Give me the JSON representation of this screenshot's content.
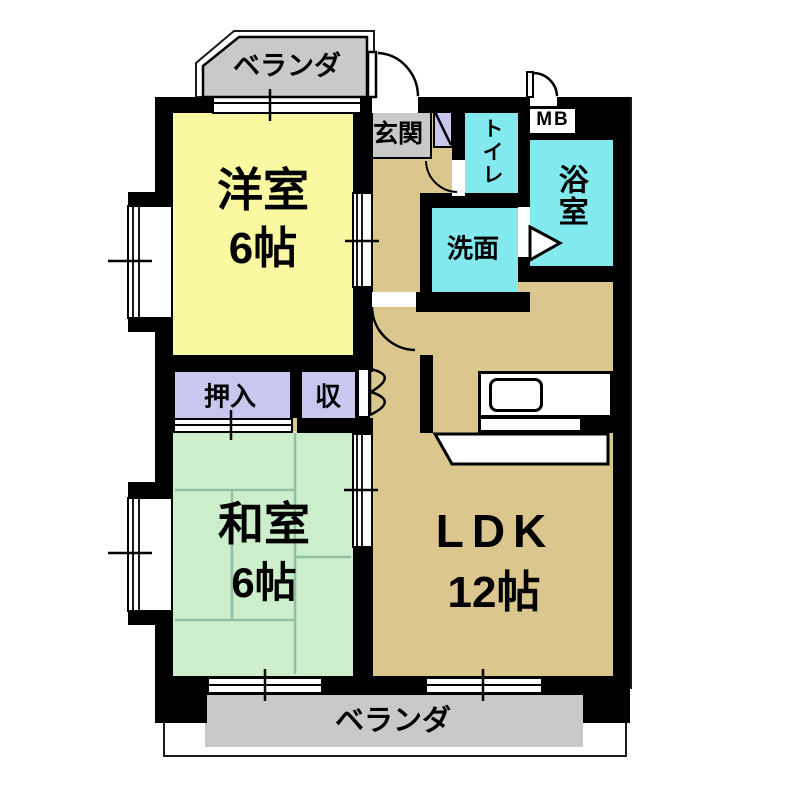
{
  "floorplan": {
    "type": "japanese-apartment-floor-plan",
    "rooms": {
      "western_room": {
        "name": "洋室",
        "size": "6帖"
      },
      "japanese_room": {
        "name": "和室",
        "size": "6帖"
      },
      "ldk": {
        "name": "LDK",
        "size": "12帖"
      },
      "entrance": {
        "name": "玄関"
      },
      "toilet": {
        "name": "トイレ"
      },
      "washroom": {
        "name": "洗面"
      },
      "bathroom": {
        "name": "浴室"
      },
      "closet_oshiire": {
        "name": "押入"
      },
      "closet_storage": {
        "name": "収"
      },
      "meter_box": {
        "name": "MB"
      },
      "veranda_top": {
        "name": "ベランダ"
      },
      "veranda_bottom": {
        "name": "ベランダ"
      }
    },
    "colors": {
      "western_room": "#FAF9A1",
      "japanese_room": "#CDEECB",
      "ldk_floor": "#DBC68D",
      "wet_area": "#82E9EF",
      "closet": "#C7C7EF",
      "veranda": "#C9C9C9",
      "wall": "#000000",
      "tatami_line": "#8FBFA4"
    }
  }
}
